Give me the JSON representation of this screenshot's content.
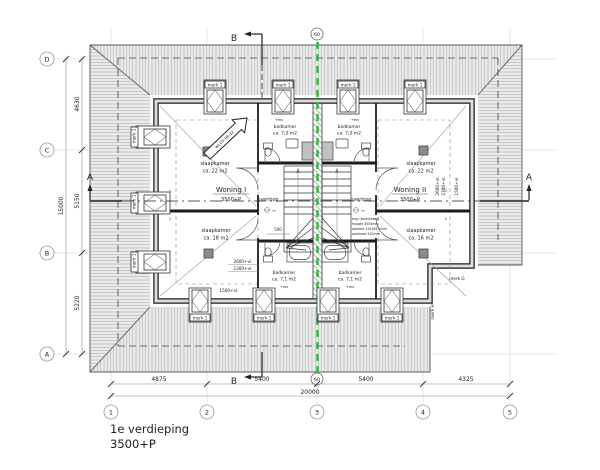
{
  "meta": {
    "title_line1": "1e verdieping",
    "title_line2": "3500+P"
  },
  "grid": {
    "cols": [
      "1",
      "2",
      "3",
      "4",
      "5"
    ],
    "rows": [
      "D",
      "C",
      "B",
      "A"
    ]
  },
  "dims": {
    "bottom": [
      "4875",
      "5400",
      "5400",
      "4325"
    ],
    "bottom_total": "20000",
    "left": [
      "4630",
      "5150",
      "5220"
    ],
    "left_total": "15000",
    "stair_width": "500"
  },
  "sections": {
    "a": "A",
    "b": "B",
    "party_wall_mark": "60"
  },
  "units": {
    "w1_name": "Woning I",
    "w1_level": "3500+P",
    "w2_name": "Woning II",
    "w2_level": "3500+P"
  },
  "rooms": {
    "room_label": "slaapkamer",
    "bath_label": "badkamer",
    "hall_label": "overloop",
    "a22": "ca. 22 m2",
    "a18": "ca. 18 m2",
    "a16": "ca. 16 m2",
    "a73": "ca. 7,3 m2",
    "a71": "ca. 7,1 m2"
  },
  "heights": {
    "h2600": "2600+vl.",
    "h2300": "2300+vl.",
    "h1500": "1500+vl."
  },
  "marks": {
    "dormer": "merk 1",
    "g": "merk G",
    "h": "merk H"
  },
  "stair_spec": {
    "l1": "trap (bereikbaar)",
    "l2": "hoogte 3500mm",
    "l3": "optrede 19x184,2mm",
    "l4": "aantrede 220mm"
  },
  "annot": {
    "mv": "+mv",
    "im": "im",
    "one": "1",
    "revision": "wz 05-06-12"
  },
  "colors": {
    "party_wall": "#2eb82e",
    "roof_fill": "#ebebeb",
    "line": "#333333"
  }
}
